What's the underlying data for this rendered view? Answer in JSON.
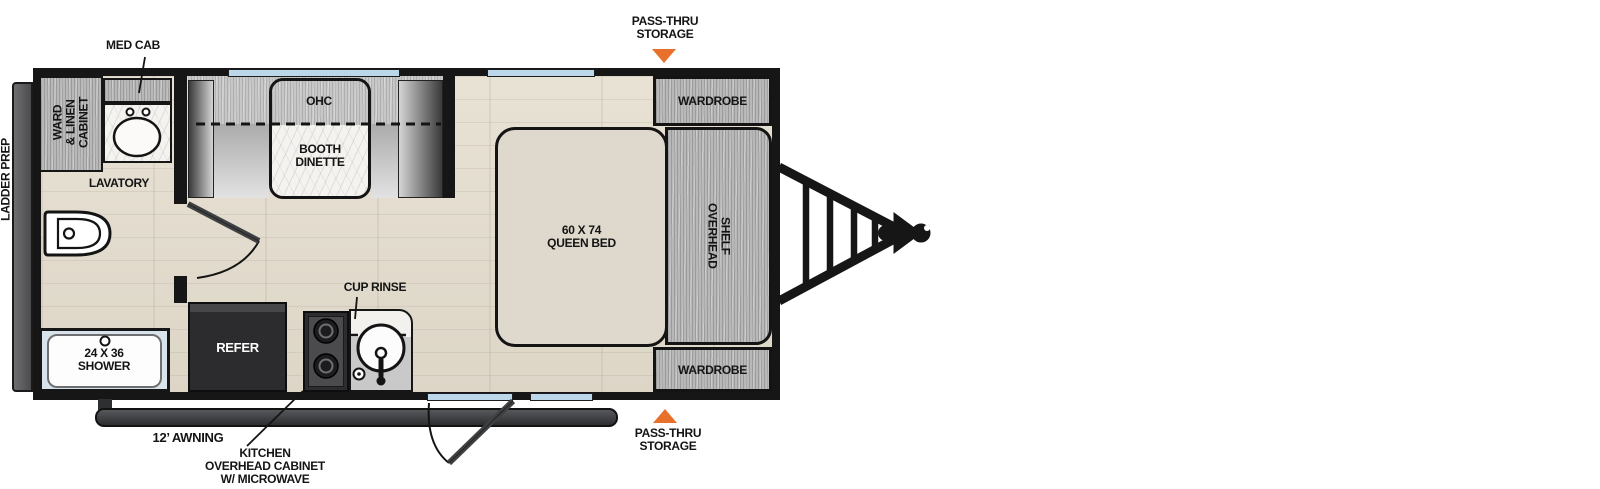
{
  "fp": {
    "labels": {
      "ladder_prep": "LADDER PREP",
      "med_cab": "MED CAB",
      "pass_thru_1": "PASS-THRU",
      "pass_thru_2": "STORAGE",
      "ward_1": "WARD",
      "ward_2": "& LINEN",
      "ward_3": "CABINET",
      "lavatory": "LAVATORY",
      "ohc": "OHC",
      "dinette_1": "BOOTH",
      "dinette_2": "DINETTE",
      "wardrobe": "WARDROBE",
      "bed_1": "60 X 74",
      "bed_2": "QUEEN BED",
      "shelf_1": "OVERHEAD",
      "shelf_2": "SHELF",
      "shower_1": "24 X 36",
      "shower_2": "SHOWER",
      "refer": "REFER",
      "cup_rinse": "CUP RINSE",
      "awning": "12’ AWNING",
      "kitchen_1": "KITCHEN",
      "kitchen_2": "OVERHEAD CABINET",
      "kitchen_3": "W/ MICROWAVE"
    },
    "colors": {
      "accent_orange": "#e8702a",
      "wall_black": "#161616",
      "floor_wood": "#e5dfd2",
      "window_blue": "#bdd7ea",
      "cabinet_gray": "#b8b8b8",
      "bed_cream": "#ded8cd",
      "appliance_dark": "#2c2c2e"
    }
  }
}
